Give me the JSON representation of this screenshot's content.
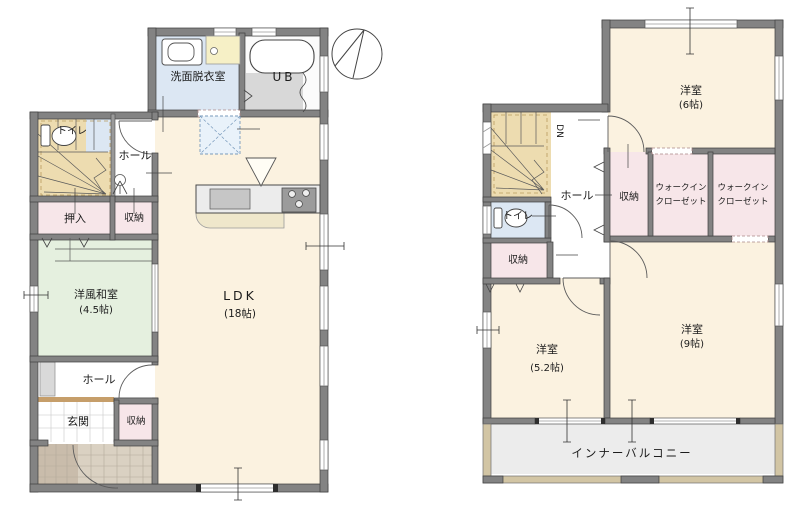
{
  "colors": {
    "cream": "#fbf2e0",
    "blue": "#dce7f3",
    "green": "#e5f0df",
    "pink": "#f7e6e9",
    "tan_stairs": "#eddcb0",
    "gray_bath": "#d8d8d8",
    "balcony": "#ececec",
    "porch_dark": "#c9bcab",
    "porch_light": "#dad1c2",
    "threshold": "#c69e6a",
    "counter_yellow": "#f6f0c6",
    "kitchen_counter": "#ececec",
    "cabinet_gray": "#d9d9d9"
  },
  "floor1": {
    "washroom": "洗面脱衣室",
    "bath": "UB",
    "toilet": "トイレ",
    "hall_upper": "ホール",
    "oshiire": "押入",
    "storage_mid": "収納",
    "washitsu": "洋風和室",
    "washitsu_size": "(4.5帖)",
    "ldk": "LDK",
    "ldk_size": "(18帖)",
    "hall_lower": "ホール",
    "genkan": "玄関",
    "storage_genkan": "収納"
  },
  "floor2": {
    "bedroom6": "洋室",
    "bedroom6_size": "(6帖)",
    "down": "DN",
    "hall": "ホール",
    "storage_mid": "収納",
    "wic_line1": "ウォークイン",
    "wic_line2": "クローゼット",
    "toilet": "トイレ",
    "storage_left": "収納",
    "bedroom52": "洋室",
    "bedroom52_size": "(5.2帖)",
    "bedroom9": "洋室",
    "bedroom9_size": "(9帖)",
    "balcony": "インナーバルコニー"
  }
}
